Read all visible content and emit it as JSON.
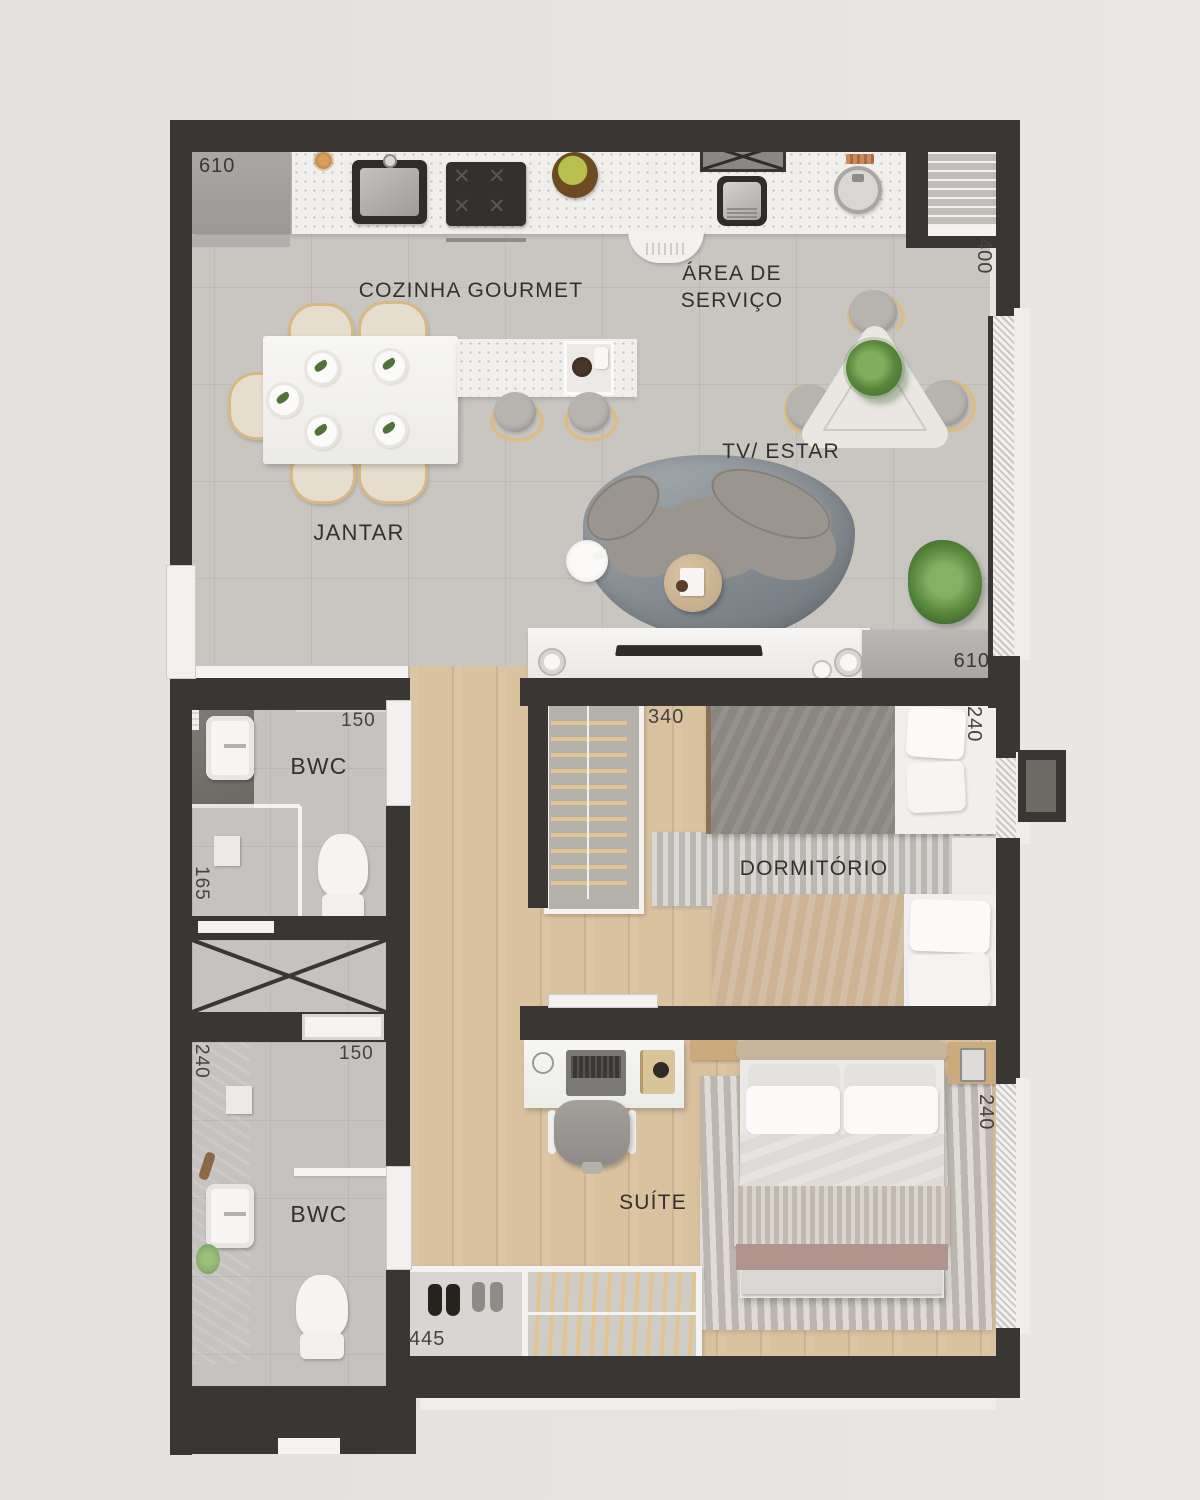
{
  "plan_title": "apartment-floor-plan",
  "rooms": {
    "kitchen": "COZINHA GOURMET",
    "service_line1": "ÁREA DE",
    "service_line2": "SERVIÇO",
    "dining": "JANTAR",
    "living": "TV/ ESTAR",
    "bwc_upper": "BWC",
    "bwc_lower": "BWC",
    "bedroom": "DORMITÓRIO",
    "suite": "SUÍTE"
  },
  "dimensions": {
    "fridge_cabinet": "610",
    "service_depth": "400",
    "bwc_upper_door": "150",
    "shower_width": "165",
    "bwc_lower_door": "150",
    "bwc_lower_depth": "240",
    "tv_console": "610",
    "bedroom_wardrobe": "340",
    "bedroom_bed": "240",
    "suite_bed": "240",
    "suite_closet": "445"
  },
  "colors": {
    "wall": "#3a3633",
    "tile_floor": "#c9c6c2",
    "wood_floor": "#d9c2a0",
    "counter": "#f0efec",
    "sofa": "#9b958f",
    "accent_plant": "#5f8c44"
  }
}
